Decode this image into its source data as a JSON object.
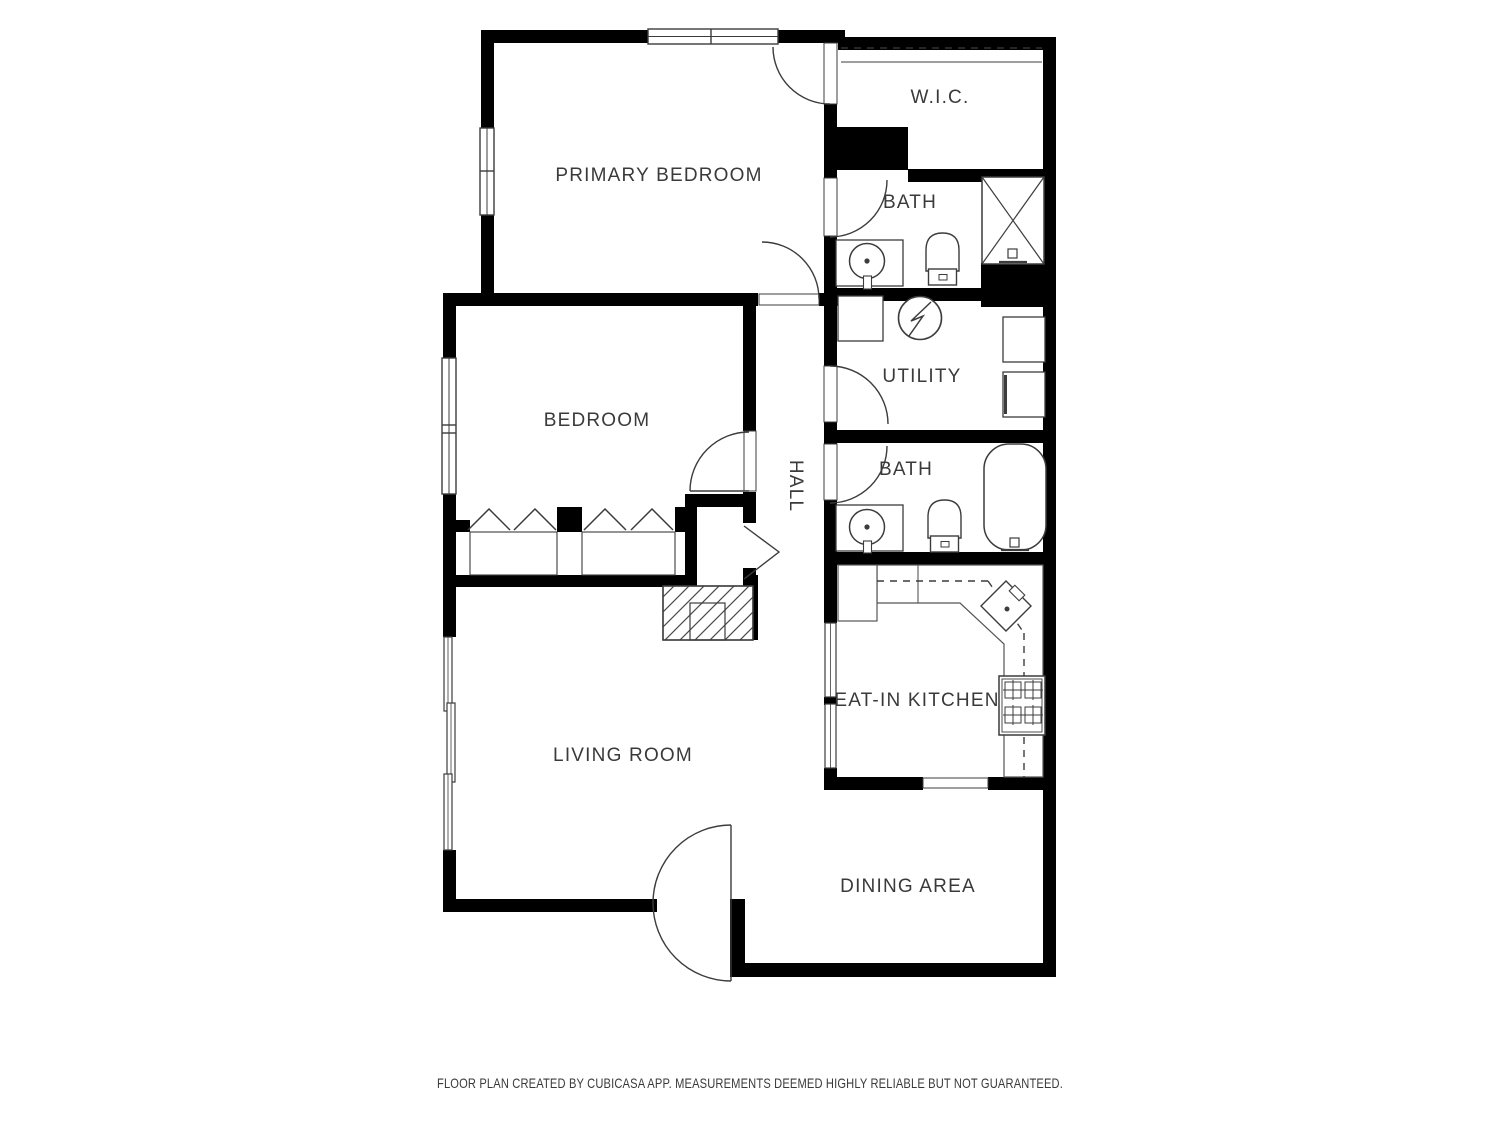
{
  "title": "Floor plan",
  "rooms": {
    "primary_bedroom": "PRIMARY BEDROOM",
    "wic": "W.I.C.",
    "bath_upper": "BATH",
    "utility": "UTILITY",
    "bath_lower": "BATH",
    "hall": "HALL",
    "bedroom": "BEDROOM",
    "eat_in_kitchen": "EAT-IN KITCHEN",
    "living_room": "LIVING ROOM",
    "dining_area": "DINING AREA"
  },
  "footer": {
    "disclaimer": "FLOOR PLAN CREATED BY CUBICASA APP. MEASUREMENTS DEEMED HIGHLY RELIABLE BUT NOT GUARANTEED."
  },
  "colors": {
    "background": "#ffffff",
    "walls": "#000000",
    "lines": "#3c3c3c",
    "text": "#3a3a3a"
  }
}
